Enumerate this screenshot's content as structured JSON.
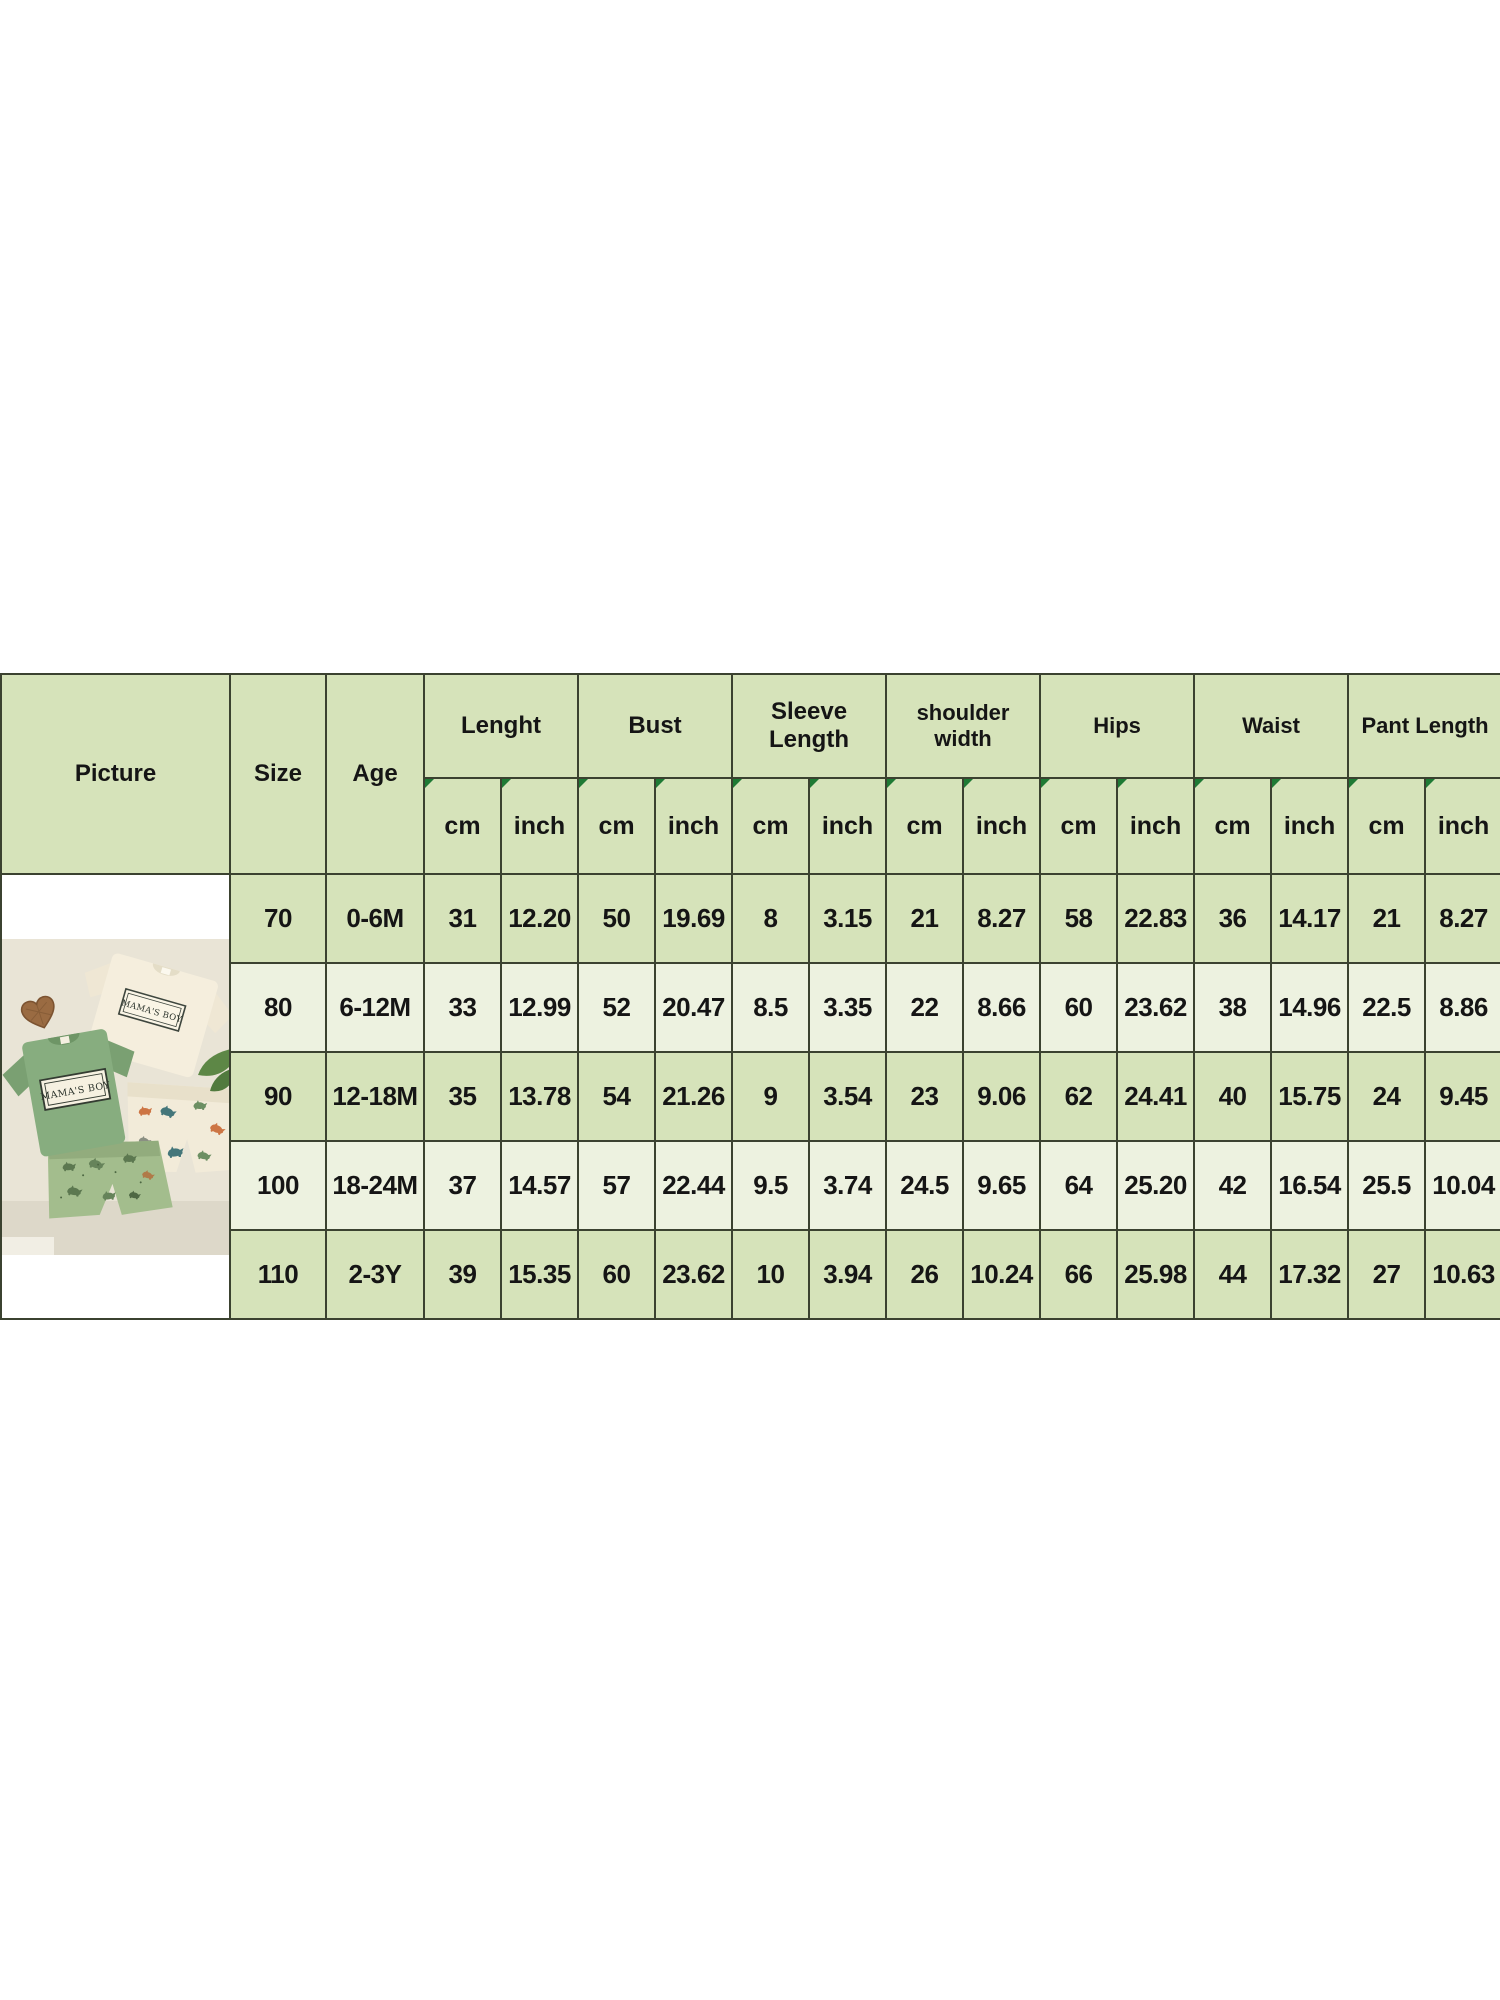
{
  "chart_data": {
    "type": "table",
    "title": "Baby outfit size chart",
    "headers": {
      "picture": "Picture",
      "size": "Size",
      "age": "Age"
    },
    "groups": [
      {
        "label": "Lenght"
      },
      {
        "label": "Bust"
      },
      {
        "label": "Sleeve Length"
      },
      {
        "label": "shoulder width"
      },
      {
        "label": "Hips"
      },
      {
        "label": "Waist"
      },
      {
        "label": "Pant Length"
      }
    ],
    "units": {
      "cm": "cm",
      "inch": "inch"
    },
    "rows": [
      {
        "size": "70",
        "age": "0-6M",
        "values": [
          "31",
          "12.20",
          "50",
          "19.69",
          "8",
          "3.15",
          "21",
          "8.27",
          "58",
          "22.83",
          "36",
          "14.17",
          "21",
          "8.27"
        ]
      },
      {
        "size": "80",
        "age": "6-12M",
        "values": [
          "33",
          "12.99",
          "52",
          "20.47",
          "8.5",
          "3.35",
          "22",
          "8.66",
          "60",
          "23.62",
          "38",
          "14.96",
          "22.5",
          "8.86"
        ]
      },
      {
        "size": "90",
        "age": "12-18M",
        "values": [
          "35",
          "13.78",
          "54",
          "21.26",
          "9",
          "3.54",
          "23",
          "9.06",
          "62",
          "24.41",
          "40",
          "15.75",
          "24",
          "9.45"
        ]
      },
      {
        "size": "100",
        "age": "18-24M",
        "values": [
          "37",
          "14.57",
          "57",
          "22.44",
          "9.5",
          "3.74",
          "24.5",
          "9.65",
          "64",
          "25.20",
          "42",
          "16.54",
          "25.5",
          "10.04"
        ]
      },
      {
        "size": "110",
        "age": "2-3Y",
        "values": [
          "39",
          "15.35",
          "60",
          "23.62",
          "10",
          "3.94",
          "26",
          "10.24",
          "66",
          "25.98",
          "44",
          "17.32",
          "27",
          "10.63"
        ]
      }
    ]
  },
  "photo": {
    "shirt_label": "MAMA'S BOY"
  },
  "colors": {
    "header_bg": "#d6e3ba",
    "row_alt_bg": "#edf2e0",
    "border": "#3b4230",
    "comment_marker": "#1e7a34",
    "photo_bg": "#e9e4d6",
    "tshirt_green": "#87ad7f",
    "tshirt_cream": "#f5eedd",
    "shorts_green": "#a3bd8d"
  }
}
